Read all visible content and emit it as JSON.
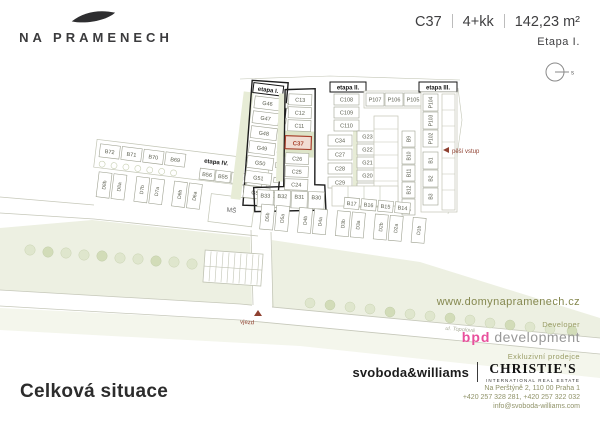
{
  "header": {
    "logo_title": "NA PRAMENECH",
    "unit": {
      "code": "C37",
      "layout": "4+kk",
      "area": "142,23 m²",
      "stage": "Etapa I."
    },
    "compass_label": "s"
  },
  "plan": {
    "stages": {
      "e1": "etapa I.",
      "e2": "etapa II.",
      "e3": "etapa III.",
      "e4": "etapa IV."
    },
    "highlight": {
      "label": "C37",
      "color": "#a8402c"
    },
    "labels": {
      "pedestrian_entry": "pěší vstup",
      "vehicle_entry": "vjezd",
      "street": "ul. Topolová",
      "kindergarten": "MŠ"
    },
    "plots": {
      "etapa1_g": [
        "G46",
        "G47",
        "G48",
        "G49",
        "G50",
        "G51",
        "G52"
      ],
      "etapa1_c_upper": [
        "C13",
        "C12",
        "C11"
      ],
      "etapa1_c_lower": [
        "C26",
        "C25",
        "C24"
      ],
      "etapa1_b_row": [
        "B33",
        "B32",
        "B31",
        "B30"
      ],
      "etapa2_c_col": [
        "C108",
        "C109",
        "C110"
      ],
      "etapa2_c_col2": [
        "C34",
        "C27",
        "C28",
        "C29"
      ],
      "etapa2_p_row": [
        "P107",
        "P106",
        "P105"
      ],
      "etapa2_g_col": [
        "G23",
        "G22",
        "G21",
        "G20",
        "G19",
        "G18"
      ],
      "etapa2_b_col": [
        "B9",
        "B10",
        "B11",
        "B12",
        "B13"
      ],
      "etapa3_p_col": [
        "P104",
        "P103",
        "P102"
      ],
      "etapa3_b_col": [
        "B1",
        "B2",
        "B3"
      ],
      "etapa4_b_row1": [
        "B72",
        "B71",
        "B70",
        "B69"
      ],
      "etapa4_b_row2": [
        "B56",
        "B55",
        "B54",
        "B53"
      ],
      "etapa4_d_row": [
        "D8b",
        "D8a",
        "D7b",
        "D7a",
        "D6b",
        "D6a"
      ],
      "south_b_row": [
        "B17",
        "B16",
        "B15",
        "B14"
      ],
      "south_d_row": [
        "D5b",
        "D5a",
        "D4b",
        "D4a",
        "D3b",
        "D3a",
        "D2b",
        "D2a",
        "D1b"
      ]
    }
  },
  "footer": {
    "website": "www.domynapramenech.cz",
    "developer_label": "Developer",
    "developer_brand": "bpd",
    "developer_suffix": "development",
    "broker_label": "Exkluzivní prodejce",
    "broker_primary": "svoboda&williams",
    "broker_secondary": "CHRISTIE'S",
    "broker_secondary_sub": "INTERNATIONAL REAL ESTATE",
    "address": [
      "Na Perštýně 2, 110 00 Praha 1",
      "+420 257 328 281, +420 257 322 032",
      "info@svoboda-williams.com"
    ]
  },
  "page_title": "Celková situace",
  "colors": {
    "accent_olive": "#8f9268",
    "brand_pink": "#e8509c",
    "highlight_red": "#a8402c"
  }
}
